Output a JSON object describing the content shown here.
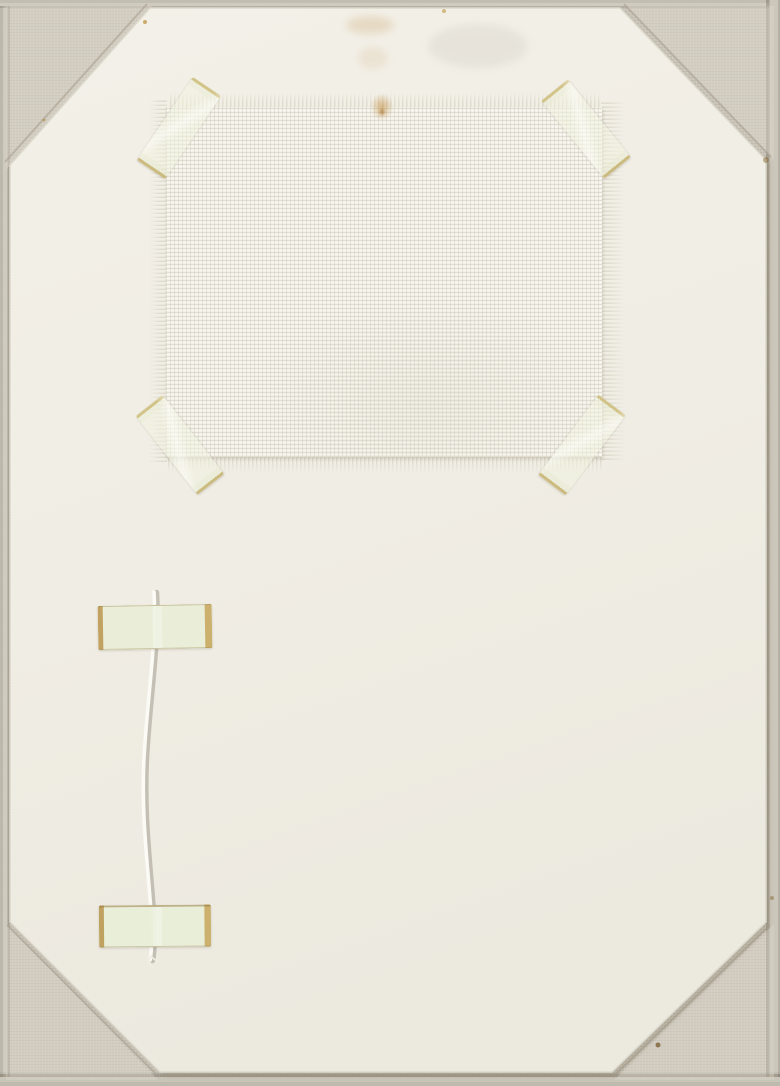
{
  "scene": {
    "medium": "Photograph of a mixed-media artwork on a linen-covered board",
    "support": {
      "name": "linen canvas board",
      "description": "Warm grey woven linen visible as a border and through the four clipped corners of the paper"
    },
    "paper": {
      "name": "mounting paper sheet",
      "description": "Large cream paper sheet covering the board, all four corners cut diagonally exposing linen triangles"
    },
    "fabric_swatch": {
      "name": "white woven fabric swatch",
      "description": "Rectangular open-weave white canvas swatch with frayed edges, mounted in the upper half, fixed by a diagonal tape strip across each corner",
      "stain": "small yellow-brown stain at top centre of the swatch"
    },
    "tapes": {
      "corner_tapes": "four translucent yellowed adhesive tape strips, glossy, placed diagonally over the swatch corners",
      "string_tapes": "two horizontal pale-green yellowed tape strips holding the string at its top and bottom"
    },
    "string": {
      "name": "white string",
      "description": "Thin white cord hanging vertically in the lower-left area, bowing slightly left, frayed at its lower end"
    },
    "marks": "faint age stains near the top edge and tiny brown specks on paper and linen",
    "colors": {
      "linen": "#cbc6ba",
      "linen_corner_triangles": "#d6d1c5",
      "paper": "#f0ede4",
      "fabric": "#f3f1e8",
      "tape_film": "#ecf0d9",
      "tape_yellow_edge": "#c9ae62",
      "string": "#fbfaf4",
      "stain": "#b9822f"
    }
  }
}
